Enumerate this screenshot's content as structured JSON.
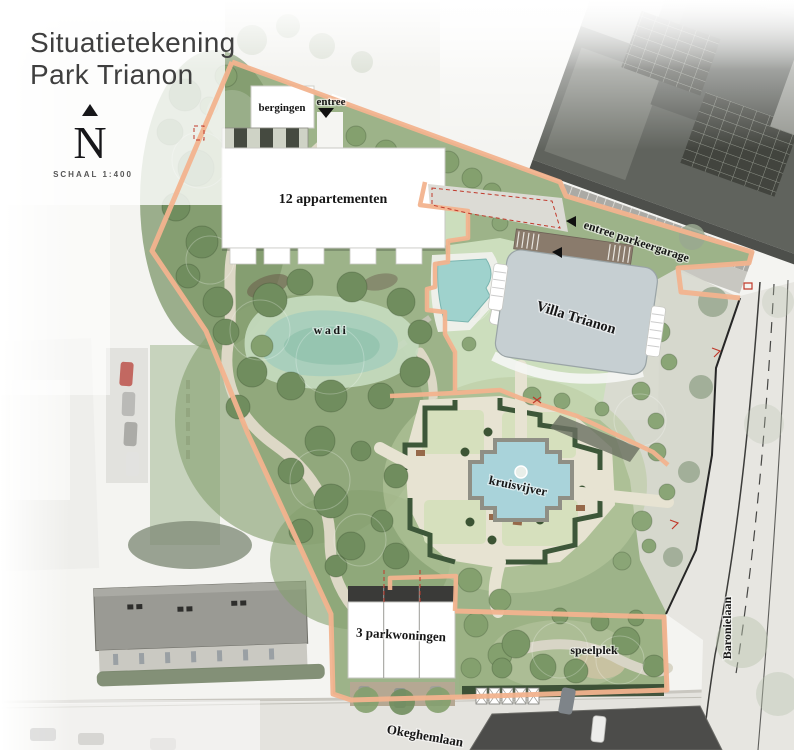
{
  "title": {
    "line1": "Situatietekening",
    "line2": "Park Trianon"
  },
  "compass": {
    "letter": "N",
    "scale_label": "SCHAAL 1:400"
  },
  "map_labels": {
    "bergingen": "bergingen",
    "entree": "entree",
    "appartementen": "12 appartementen",
    "entree_parkeergarage": "entree parkeergarage",
    "villa_trianon": "Villa Trianon",
    "wadi": "wadi",
    "kruisvijver": "kruisvijver",
    "parkwoningen": "3 parkwoningen",
    "speelplek": "speelplek"
  },
  "street_labels": {
    "okeghemlaan": "Okeghemlaan",
    "baronielaan": "Baronielaan"
  },
  "colors": {
    "plan_boundary": "#f2b38e",
    "villa": "#c6cfd2",
    "water_wadi": "#a9cfbc",
    "water_kruisvijver": "#a9d3da",
    "water_pool": "#9fd2cd",
    "park_green": "#9db389"
  }
}
